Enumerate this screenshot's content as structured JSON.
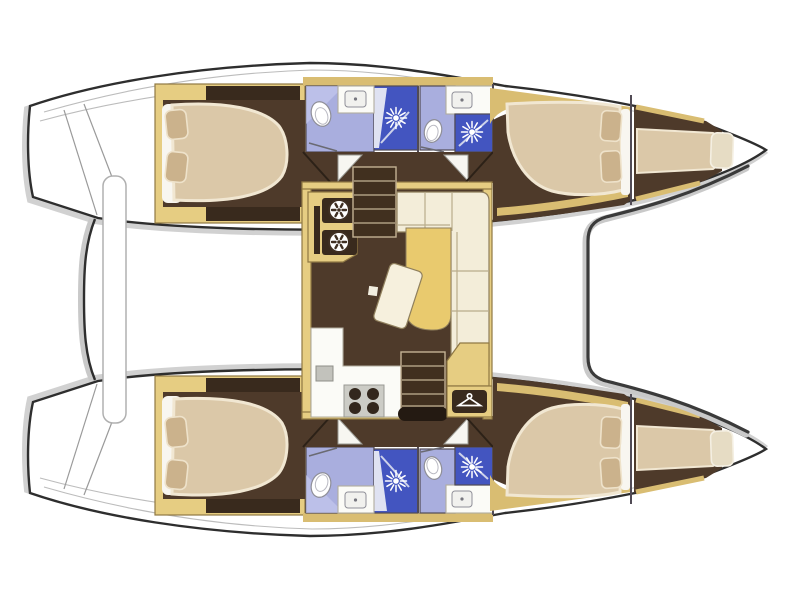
{
  "title": "Catamaran sailing yacht interior layout plan — top view, bow to the right, 4 cabins, 4 bathrooms, central salon",
  "colors": {
    "outline": "#2e2e2e",
    "shadow": "#c9c9c9",
    "deck": "#ffffff",
    "wood": "#e6cd82",
    "wood_stroke": "#8f7844",
    "wood_band": "#d9bd72",
    "floor": "#4e3a2a",
    "locker": "#392a1d",
    "bed": "#dbc8a8",
    "bed_edge": "#f1e7d2",
    "pillow": "#cbb28c",
    "pillow_edge": "#eee2ca",
    "sheet": "#f8f6f0",
    "lavender": "#a9aede",
    "lavender_light": "#c6c9ee",
    "shower_blue": "#4355c0",
    "glass": "#cdd2ea",
    "sofa": "#f3edd9",
    "sofa_line": "#8f7f5c",
    "seam": "#b9ac8c",
    "chaise": "#e9ca6e",
    "table": "#f6f0dd",
    "stair": "#41301f",
    "stair_line": "#c3b294",
    "counter": "#fbfbf7",
    "counter_line": "#b1ac9e",
    "stove": "#ccccc6",
    "burner": "#33271d",
    "fixture_line": "#8f8f98",
    "wall": "#514b55",
    "beam_line": "#b0b0b0",
    "landing": "#241a12",
    "ring": "#3f2f22"
  },
  "vessel": {
    "type": "catamaran",
    "view": "deck layout plan from above",
    "orientation": "bow-right, stern-left",
    "hulls": [
      {
        "name": "port hull (top)",
        "rooms": [
          {
            "name": "aft double cabin",
            "features": [
              "island double bed",
              "2 pillows",
              "storage lockers"
            ]
          },
          {
            "name": "aft bathroom",
            "features": [
              "toilet",
              "washbasin",
              "separate shower"
            ]
          },
          {
            "name": "forward bathroom",
            "features": [
              "toilet",
              "washbasin",
              "separate shower"
            ]
          },
          {
            "name": "forward double cabin",
            "features": [
              "double bed",
              "2 pillows"
            ]
          },
          {
            "name": "bow single berth",
            "features": [
              "single mattress",
              "pillow"
            ]
          }
        ]
      },
      {
        "name": "starboard hull (bottom)",
        "mirror_of": "port hull (top)"
      }
    ],
    "salon": {
      "name": "salon / bridgedeck",
      "features": [
        "galley unit with two burner rings",
        "forward companionway stairs",
        "L-shaped sofa",
        "chaise cushion",
        "cocktail table",
        "galley counter with sink and 4-burner stove",
        "aft companionway stairs",
        "wardrobe with hanger symbol"
      ]
    },
    "deck": {
      "features": [
        "stern transom steps",
        "aft crossbeam bar",
        "forward crossbeam"
      ]
    }
  },
  "icons": [
    {
      "name": "shower-head-icon",
      "glyph": "white starburst"
    },
    {
      "name": "toilet-icon",
      "glyph": "white oval with seat"
    },
    {
      "name": "washbasin-icon",
      "glyph": "rounded square with drain dot"
    },
    {
      "name": "stove-burner-icon",
      "glyph": "ring with radiating petals"
    },
    {
      "name": "hanger-icon",
      "glyph": "clothes hanger on dark plaque"
    },
    {
      "name": "stairs-icon",
      "glyph": "dark treads with light lines"
    }
  ]
}
